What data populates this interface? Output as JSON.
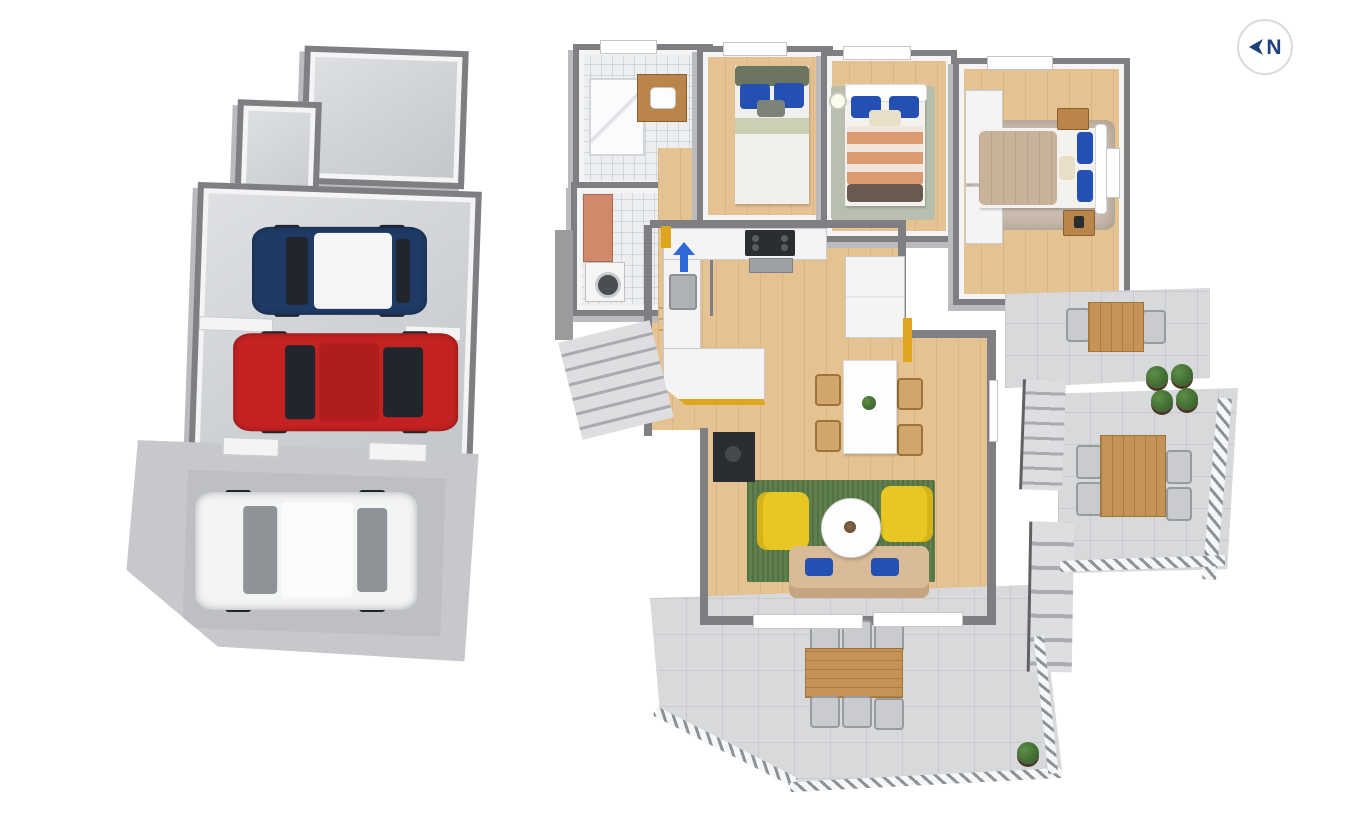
{
  "compass": {
    "label": "N"
  },
  "colors": {
    "wall": "#7f7f83",
    "wall-light": "#9b9b9e",
    "inner-wall": "#f4f4f5",
    "concrete": "#cdd0d4",
    "driveway": "#c6c8cb",
    "drive-pad": "#bdbfc2",
    "tile-floor": "#eceef0",
    "wood": "#e5c291",
    "terrace": "#d7d9db",
    "car-blue": "#1f3a64",
    "car-red": "#c32222",
    "car-white": "#f3f4f4",
    "glass": "#20262c",
    "cabinet-yellow": "#dfa51e",
    "rug-green": "#5f7f4c",
    "chair-yellow": "#e9c722",
    "sofa-beige": "#d9bb97",
    "pillow-blue": "#2450b4",
    "headboard-green": "#6b7560",
    "sage": "#cdcfb5",
    "blanket-salmon": "#dd9a70",
    "blanket-tan": "#c8b29a",
    "rug-tan": "#c9bcae",
    "rug-sage": "#b9bfae",
    "washer-copper": "#d08a6b",
    "table-wood": "#c59357",
    "arrow-blue": "#2e6bd8",
    "compass-navy": "#1e3f7f",
    "stove-black": "#2b2e31",
    "plant-green": "#3f6b33",
    "railing-gray": "#8b8e91"
  },
  "scene": {
    "garage": {
      "rooms": [
        "storage-room",
        "storage-annex",
        "garage"
      ],
      "vehicles": [
        {
          "type": "hatchback",
          "body_color": "car-blue",
          "roof": "white"
        },
        {
          "type": "sedan",
          "body_color": "car-red",
          "roof": "black-glass"
        },
        {
          "type": "sedan",
          "body_color": "car-white",
          "roof": "white"
        }
      ]
    },
    "house": {
      "rooms": [
        "bathroom",
        "laundry",
        "hallway",
        "bedroom-1",
        "bedroom-2",
        "master-bedroom",
        "kitchen",
        "dining-area",
        "living-room",
        "entry"
      ],
      "outdoor": [
        "upper-terrace",
        "lower-terrace",
        "patio",
        "exterior-stairs"
      ]
    }
  }
}
